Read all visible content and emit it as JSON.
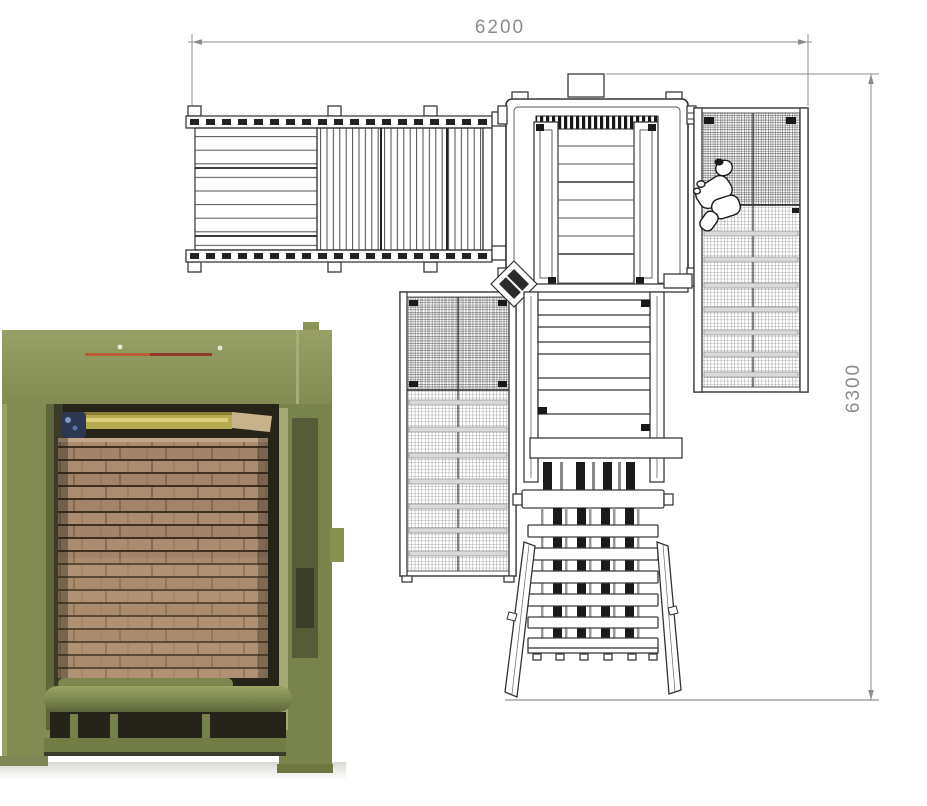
{
  "drawing": {
    "dimensions": {
      "width_label": "6200",
      "height_label": "6300"
    }
  },
  "colors": {
    "line": "#3a3a3a",
    "line_soft": "#606060",
    "dim_color": "#8c8c8c",
    "machine_green": "#87914f",
    "machine_green_dark": "#6e7742",
    "machine_green_light": "#99a26b",
    "timber": "#a3846a",
    "timber_light": "#c5a47f",
    "timber_gap": "#3f3020",
    "beam_yellow": "#b7a94f",
    "accent_red": "#b04a2e",
    "object_blue": "#2c3752"
  }
}
